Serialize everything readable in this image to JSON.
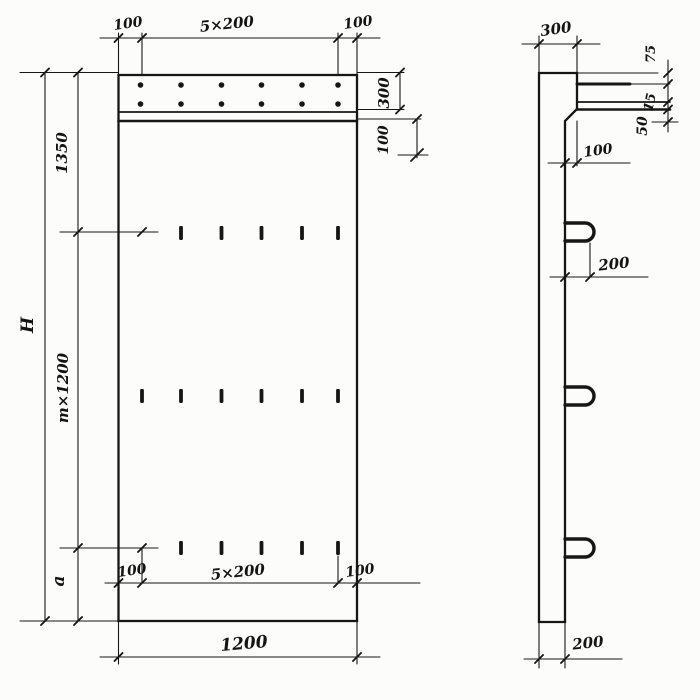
{
  "drawing": {
    "front_view": {
      "top": {
        "left_offset": "100",
        "spacing": "5×200",
        "right_offset": "100"
      },
      "right": {
        "band_height": "300",
        "band_gap": "100"
      },
      "left": {
        "overall_height": "H",
        "upper_segment": "1350",
        "middle_segment": "m×1200",
        "lower_segment": "a"
      },
      "bottom": {
        "left_offset": "100",
        "spacing": "5×200",
        "right_offset": "100",
        "overall_width": "1200"
      }
    },
    "side_view": {
      "top_width": "300",
      "ledge_top": "75",
      "plate_thickness": "15",
      "ledge_gap": "50",
      "chamfer_offset": "100",
      "hook_spacing": "200",
      "wall_thickness": "200"
    }
  }
}
